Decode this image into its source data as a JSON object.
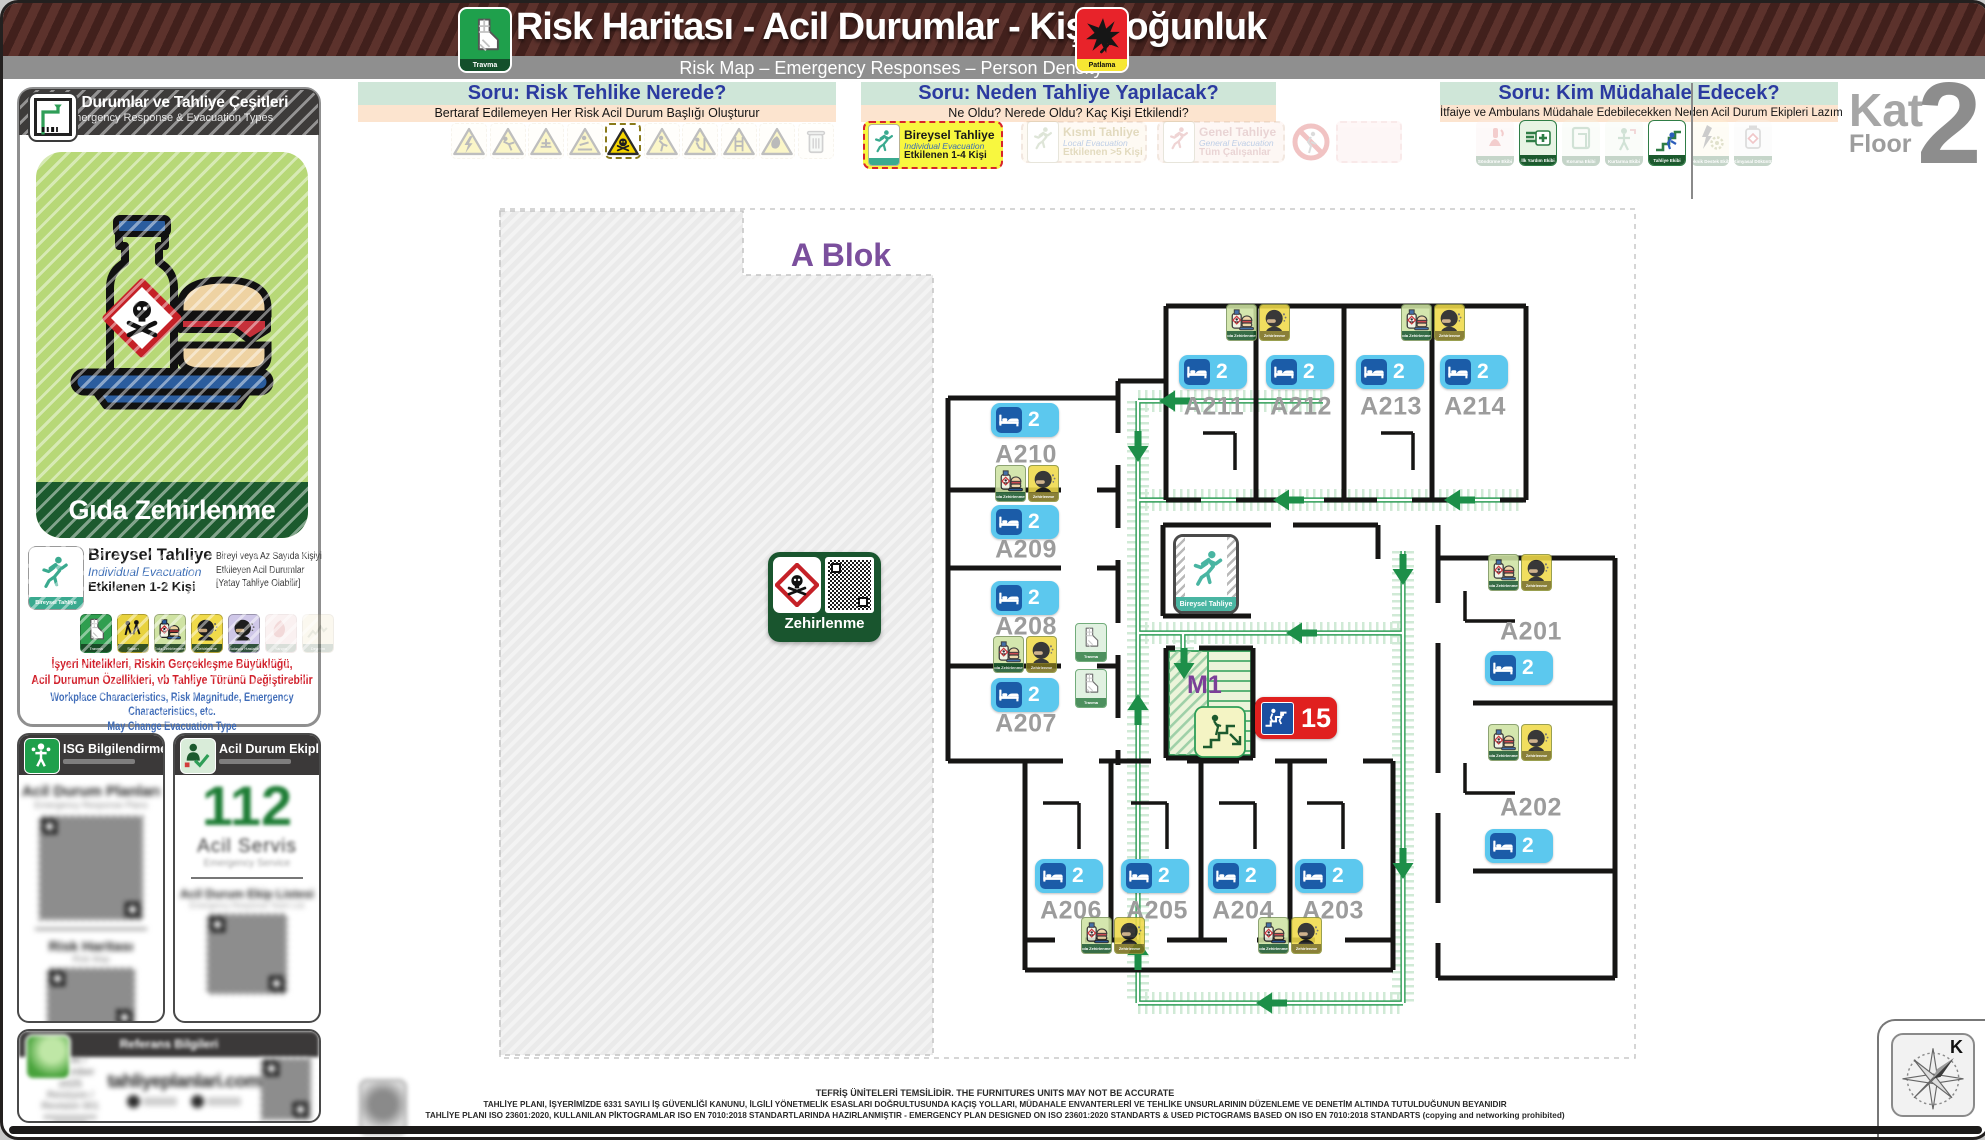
{
  "header": {
    "title": "Risk Haritası - Acil Durumlar - Kişi Yoğunluk",
    "subtitle": "Risk Map – Emergency Responses – Person Density",
    "trauma_icon_label": "Travma",
    "explosion_icon_label": "Patlama"
  },
  "floor_indicator": {
    "kat": "Kat",
    "floor": "Floor",
    "number": "2"
  },
  "questions": {
    "q1": {
      "title": "Soru: Risk Tehlike Nerede?",
      "subtitle": "Bertaraf Edilemeyen Her Risk Acil Durum Başlığı Oluşturur",
      "icons": [
        "electric-warning",
        "fall-warning",
        "hand-injury-warning",
        "slip-warning",
        "toxic-warning",
        "evacuation-warning",
        "obstacle-warning",
        "ladder-warning",
        "flammable-warning",
        "waste-warning"
      ],
      "active_icon": "toxic-warning"
    },
    "q2": {
      "title": "Soru: Neden Tahliye Yapılacak?",
      "subtitle": "Ne Oldu? Nerede Oldu? Kaç Kişi Etkilendi?",
      "options": [
        {
          "title": "Bireysel Tahliye",
          "subtitle": "Individual Evacuation",
          "detail": "Etkilenen 1-4 Kişi",
          "active": true
        },
        {
          "title": "Kısmi Tahliye",
          "subtitle": "Local Evacuation",
          "detail": "Etkilenen >5 Kişi",
          "active": false
        },
        {
          "title": "Genel Tahliye",
          "subtitle": "General Evacuation",
          "detail": "Tüm Çalışanlar",
          "active": false
        }
      ]
    },
    "q3": {
      "title": "Soru: Kim Müdahale Edecek?",
      "subtitle": "İtfaiye ve Ambulans Müdahale Edebilecekken Neden Acil Durum Ekipleri Lazım",
      "teams": [
        {
          "label": "Söndürme Ekibi",
          "active": false
        },
        {
          "label": "İlk Yardım Ekibi",
          "active": true
        },
        {
          "label": "Koruma Ekibi",
          "active": false
        },
        {
          "label": "Kurtarma Ekibi",
          "active": false
        },
        {
          "label": "Tahliye Ekibi",
          "active": true
        },
        {
          "label": "Teknik Destek Ekibi",
          "active": false
        },
        {
          "label": "Kimyasal Döküntü",
          "active": false
        }
      ]
    }
  },
  "sidebar": {
    "panel_title": "Acil Durumlar ve Tahliye Çeşitleri",
    "panel_subtitle": "Emergency Response & Evacuation Types",
    "risk_title": "Gıda Zehirlenme",
    "evac_type": {
      "title": "Bireysel Tahliye",
      "subtitle": "Individual Evacuation",
      "affected": "Etkilenen 1-2 Kişi",
      "sign_label": "Bireysel Tahliye",
      "desc1": "Bireyi veya Az Sayıda Kişiyi",
      "desc2": "Etkileyen Acil Durumlar",
      "desc3": "[Yatay Tahliye Olabilir]"
    },
    "icon_labels": [
      "Travma",
      "Saldırı",
      "Gıda Zehirlenmesi",
      "Zehirlenme",
      "Bulaşıcı Hastalık",
      "Yangın",
      "Deprem"
    ],
    "note_tr1": "İşyeri Nitelikleri, Riskin Gerçekleşme Büyüklüğü,",
    "note_tr2": "Acil Durumun Özellikleri, vb Tahliye Türünü Değiştirebilir",
    "note_en1": "Workplace Characteristics, Risk Magnitude, Emergency Characteristics, etc.",
    "note_en2": "May Change Evacuation Type",
    "isg_panel": {
      "title": "ISG Bilgilendirme",
      "item1": "Acil Durum Planları",
      "item1_en": "Emergency Response Plans",
      "item2": "Risk Haritası",
      "item2_en": "Risk Map"
    },
    "team_panel": {
      "title": "Acil Durum Ekipleri",
      "number": "112",
      "service": "Acil Servis",
      "service_en": "Emergency Service",
      "list": "Acil Durum Ekip Listesi",
      "list_en": "Emergency Response Team List"
    },
    "ref_panel": {
      "title": "Referans Bilgileri",
      "date": "Aralık / December 2025",
      "revision": "Revizyon / Revision  001",
      "site": "tahliyeplanlari.com"
    }
  },
  "plan": {
    "block_label": "A Blok",
    "stairwell_label": "M1",
    "stairwell_capacity": "15",
    "hazard_badge_label": "Zehirlenme",
    "evacuation_sign_label": "Bireysel Tahliye",
    "room_icon_labels": {
      "food_poisoning": "Gıda Zehirlenmesi",
      "poisoning": "Zehirlenme",
      "trauma": "Travma"
    },
    "rooms": [
      {
        "name": "A201",
        "beds": "2"
      },
      {
        "name": "A202",
        "beds": "2"
      },
      {
        "name": "A203",
        "beds": "2"
      },
      {
        "name": "A204",
        "beds": "2"
      },
      {
        "name": "A205",
        "beds": "2"
      },
      {
        "name": "A206",
        "beds": "2"
      },
      {
        "name": "A207",
        "beds": "2"
      },
      {
        "name": "A208",
        "beds": "2"
      },
      {
        "name": "A209",
        "beds": "2"
      },
      {
        "name": "A210",
        "beds": "2"
      },
      {
        "name": "A211",
        "beds": "2"
      },
      {
        "name": "A212",
        "beds": "2"
      },
      {
        "name": "A213",
        "beds": "2"
      },
      {
        "name": "A214",
        "beds": "2"
      }
    ]
  },
  "compass": {
    "north": "K"
  },
  "footer": {
    "line1": "TEFRİŞ ÜNİTELERİ TEMSİLİDİR. THE FURNITURES UNITS MAY NOT BE ACCURATE",
    "line2": "TAHLİYE PLANI, İŞYERİMİZDE 6331 SAYILI İŞ GÜVENLİĞİ KANUNU, İLGİLİ YÖNETMELİK ESASLARI DOĞRULTUSUNDA KAÇIŞ YOLLARI, MÜDAHALE ENVANTERLERİ VE TEHLİKE UNSURLARININ DÜZENLEME VE DENETİM ALTINDA TUTULDUĞUNUN BEYANIDIR",
    "line3": "TAHLİYE PLANI ISO 23601:2020, KULLANILAN PİKTOGRAMLAR ISO EN 7010:2018 STANDARTLARINDA HAZIRLANMIŞTIR - EMERGENCY PLAN DESIGNED ON ISO 23601:2020 STANDARTS & USED PICTOGRAMS BASED ON ISO EN 7010:2018 STANDARTS (copying and networking prohibited)"
  }
}
